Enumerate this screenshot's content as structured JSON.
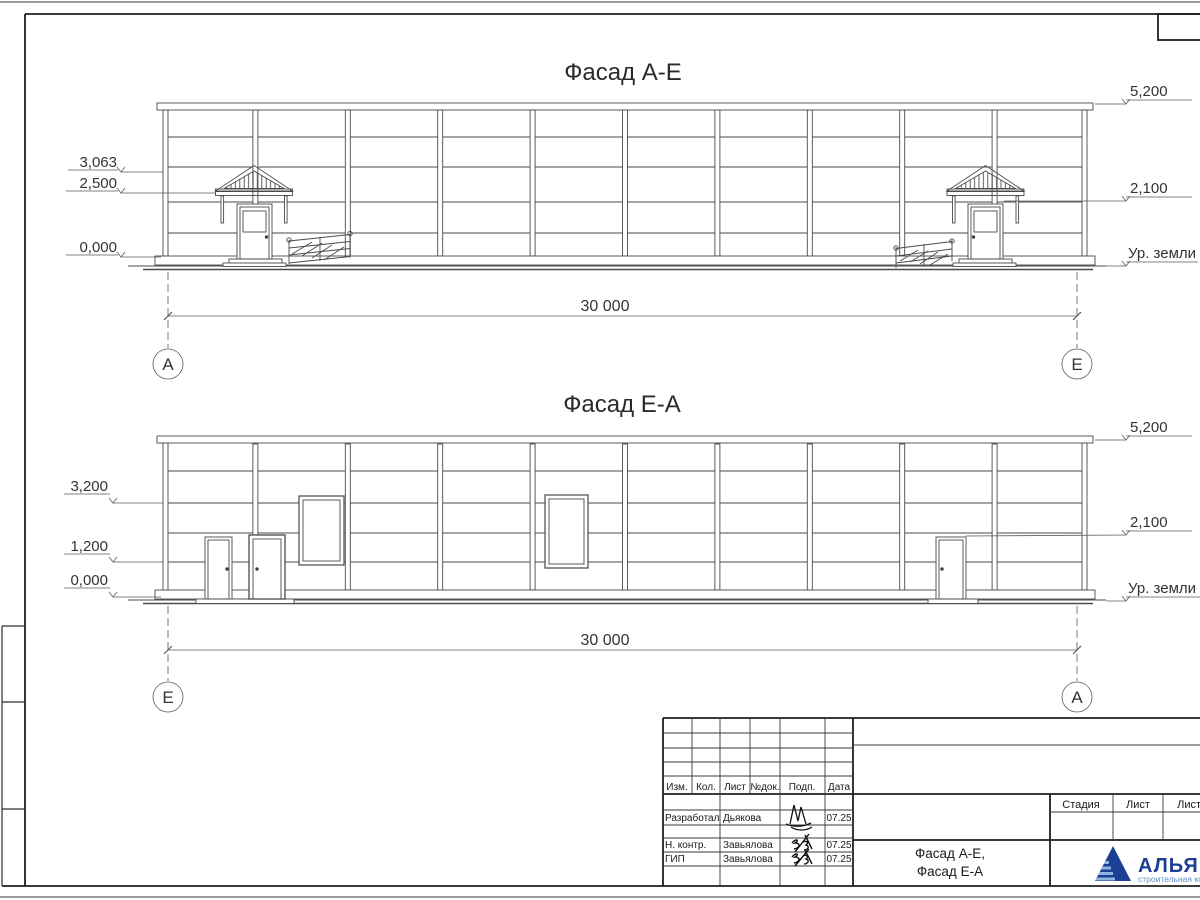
{
  "facade_ae": {
    "title": "Фасад А-Е",
    "levels_left": {
      "apex": "3,063",
      "canopy": "2,500",
      "zero": "0,000"
    },
    "levels_right": {
      "top": "5,200",
      "door": "2,100",
      "ground": "Ур. земли"
    },
    "span": "30 000",
    "axis_left": "А",
    "axis_right": "Е"
  },
  "facade_ea": {
    "title": "Фасад Е-А",
    "levels_left": {
      "mid": "3,200",
      "low": "1,200",
      "zero": "0,000"
    },
    "levels_right": {
      "top": "5,200",
      "door": "2,100",
      "ground": "Ур. земли"
    },
    "span": "30 000",
    "axis_left": "Е",
    "axis_right": "А"
  },
  "title_block": {
    "columns": [
      "Изм.",
      "Кол.",
      "Лист",
      "№док.",
      "Подп.",
      "Дата"
    ],
    "rows": [
      {
        "role": "Разработал",
        "name": "Дьякова",
        "date": "07.25"
      },
      {
        "role": "Н. контр.",
        "name": "Завьялова",
        "date": "07.25"
      },
      {
        "role": "ГИП",
        "name": "Завьялова",
        "date": "07.25"
      }
    ],
    "stage_columns": [
      "Стадия",
      "Лист",
      "Листов"
    ],
    "sheet_name_line1": "Фасад А-Е,",
    "sheet_name_line2": "Фасад Е-А",
    "logo": {
      "text": "АЛЬЯНС",
      "subtitle": "строительная компания",
      "dark": "#1c3f94",
      "light": "#5e8fcb"
    }
  }
}
